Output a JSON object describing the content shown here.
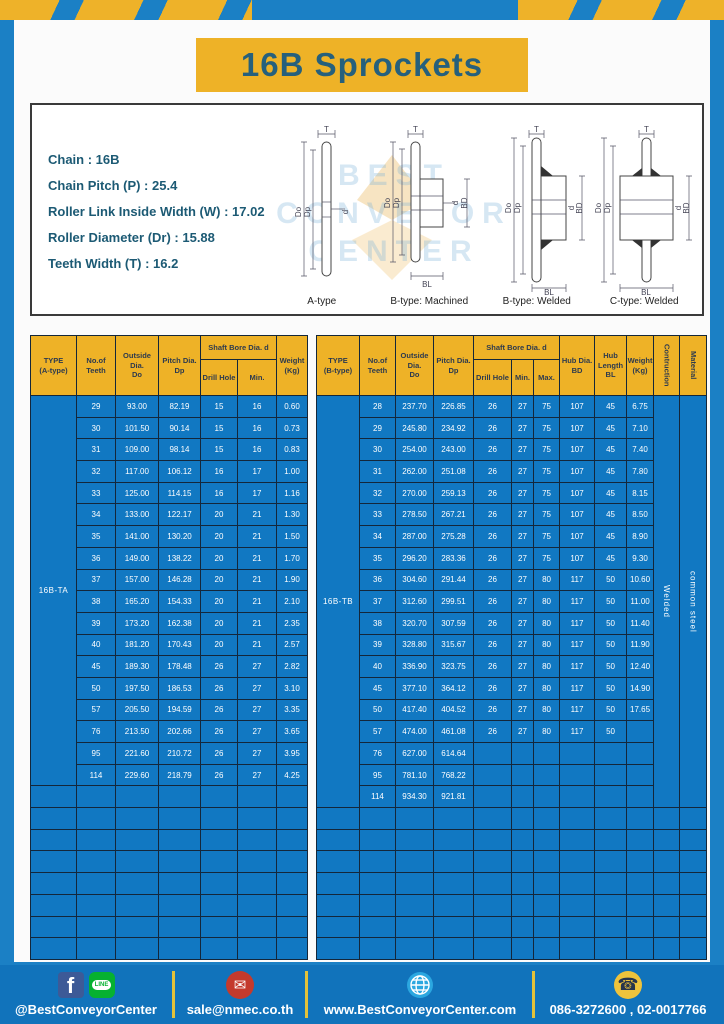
{
  "title": "16B Sprockets",
  "specs": {
    "lines": [
      "Chain  :  16B",
      "Chain Pitch (P)  :  25.4",
      "Roller Link Inside Width (W)  :  17.02",
      "Roller Diameter (Dr)  : 15.88",
      "Teeth Width (T)  :  16.2"
    ]
  },
  "dims": {
    "T": "T",
    "Do": "Do",
    "Dp": "Dp",
    "d": "d",
    "BD": "BD",
    "BL": "BL"
  },
  "watermark": "BEST CONVEYOR CENTER",
  "drawings": [
    {
      "caption": "A-type"
    },
    {
      "caption": "B-type: Machined"
    },
    {
      "caption": "B-type: Welded"
    },
    {
      "caption": "C-type: Welded"
    }
  ],
  "table_a": {
    "type_label": "16B-TA",
    "headers": {
      "type": "TYPE\n(A-type)",
      "teeth": "No.of\nTeeth",
      "outside": "Outside\nDia.\nDo",
      "pitch": "Pitch Dia.\nDp",
      "shaft_group": "Shaft Bore Dia. d",
      "drill": "Drill Hole",
      "min": "Min.",
      "weight": "Weight\n(Kg)"
    },
    "rows": [
      [
        "29",
        "93.00",
        "82.19",
        "15",
        "16",
        "0.60"
      ],
      [
        "30",
        "101.50",
        "90.14",
        "15",
        "16",
        "0.73"
      ],
      [
        "31",
        "109.00",
        "98.14",
        "15",
        "16",
        "0.83"
      ],
      [
        "32",
        "117.00",
        "106.12",
        "16",
        "17",
        "1.00"
      ],
      [
        "33",
        "125.00",
        "114.15",
        "16",
        "17",
        "1.16"
      ],
      [
        "34",
        "133.00",
        "122.17",
        "20",
        "21",
        "1.30"
      ],
      [
        "35",
        "141.00",
        "130.20",
        "20",
        "21",
        "1.50"
      ],
      [
        "36",
        "149.00",
        "138.22",
        "20",
        "21",
        "1.70"
      ],
      [
        "37",
        "157.00",
        "146.28",
        "20",
        "21",
        "1.90"
      ],
      [
        "38",
        "165.20",
        "154.33",
        "20",
        "21",
        "2.10"
      ],
      [
        "39",
        "173.20",
        "162.38",
        "20",
        "21",
        "2.35"
      ],
      [
        "40",
        "181.20",
        "170.43",
        "20",
        "21",
        "2.57"
      ],
      [
        "45",
        "189.30",
        "178.48",
        "26",
        "27",
        "2.82"
      ],
      [
        "50",
        "197.50",
        "186.53",
        "26",
        "27",
        "3.10"
      ],
      [
        "57",
        "205.50",
        "194.59",
        "26",
        "27",
        "3.35"
      ],
      [
        "76",
        "213.50",
        "202.66",
        "26",
        "27",
        "3.65"
      ],
      [
        "95",
        "221.60",
        "210.72",
        "26",
        "27",
        "3.95"
      ],
      [
        "114",
        "229.60",
        "218.79",
        "26",
        "27",
        "4.25"
      ]
    ],
    "empty_rows": 8
  },
  "table_b": {
    "type_label": "16B-TB",
    "headers": {
      "type": "TYPE\n(B-type)",
      "teeth": "No.of\nTeeth",
      "outside": "Outside\nDia.\nDo",
      "pitch": "Pitch Dia.\nDp",
      "shaft_group": "Shaft Bore Dia. d",
      "drill": "Drill Hole",
      "min": "Min.",
      "max": "Max.",
      "hub_dia": "Hub Dia.\nBD",
      "hub_len": "Hub\nLength\nBL",
      "weight": "Weight\n(Kg)",
      "construction": "Contruction",
      "material": "Material"
    },
    "construction_value": "Welded",
    "material_value": "common steel",
    "rows": [
      [
        "28",
        "237.70",
        "226.85",
        "26",
        "27",
        "75",
        "107",
        "45",
        "6.75"
      ],
      [
        "29",
        "245.80",
        "234.92",
        "26",
        "27",
        "75",
        "107",
        "45",
        "7.10"
      ],
      [
        "30",
        "254.00",
        "243.00",
        "26",
        "27",
        "75",
        "107",
        "45",
        "7.40"
      ],
      [
        "31",
        "262.00",
        "251.08",
        "26",
        "27",
        "75",
        "107",
        "45",
        "7.80"
      ],
      [
        "32",
        "270.00",
        "259.13",
        "26",
        "27",
        "75",
        "107",
        "45",
        "8.15"
      ],
      [
        "33",
        "278.50",
        "267.21",
        "26",
        "27",
        "75",
        "107",
        "45",
        "8.50"
      ],
      [
        "34",
        "287.00",
        "275.28",
        "26",
        "27",
        "75",
        "107",
        "45",
        "8.90"
      ],
      [
        "35",
        "296.20",
        "283.36",
        "26",
        "27",
        "75",
        "107",
        "45",
        "9.30"
      ],
      [
        "36",
        "304.60",
        "291.44",
        "26",
        "27",
        "80",
        "117",
        "50",
        "10.60"
      ],
      [
        "37",
        "312.60",
        "299.51",
        "26",
        "27",
        "80",
        "117",
        "50",
        "11.00"
      ],
      [
        "38",
        "320.70",
        "307.59",
        "26",
        "27",
        "80",
        "117",
        "50",
        "11.40"
      ],
      [
        "39",
        "328.80",
        "315.67",
        "26",
        "27",
        "80",
        "117",
        "50",
        "11.90"
      ],
      [
        "40",
        "336.90",
        "323.75",
        "26",
        "27",
        "80",
        "117",
        "50",
        "12.40"
      ],
      [
        "45",
        "377.10",
        "364.12",
        "26",
        "27",
        "80",
        "117",
        "50",
        "14.90"
      ],
      [
        "50",
        "417.40",
        "404.52",
        "26",
        "27",
        "80",
        "117",
        "50",
        "17.65"
      ],
      [
        "57",
        "474.00",
        "461.08",
        "26",
        "27",
        "80",
        "117",
        "50",
        ""
      ],
      [
        "76",
        "627.00",
        "614.64",
        "",
        "",
        "",
        "",
        "",
        ""
      ],
      [
        "95",
        "781.10",
        "768.22",
        "",
        "",
        "",
        "",
        "",
        ""
      ],
      [
        "114",
        "934.30",
        "921.81",
        "",
        "",
        "",
        "",
        "",
        ""
      ]
    ],
    "empty_rows": 7
  },
  "footer": {
    "items": [
      {
        "icons": [
          "facebook-icon",
          "line-icon"
        ],
        "label": "@BestConveyorCenter"
      },
      {
        "icons": [
          "email-icon"
        ],
        "label": "sale@nmec.co.th"
      },
      {
        "icons": [
          "globe-icon"
        ],
        "label": "www.BestConveyorCenter.com"
      },
      {
        "icons": [
          "phone-icon"
        ],
        "label": "086-3272600 , 02-0017766"
      }
    ],
    "line_icon_text": "LINE",
    "fb_icon_text": "f"
  },
  "colors": {
    "frame_blue": "#1b80c5",
    "accent_yellow": "#eeb227",
    "table_blue": "#1178c2",
    "footer_blue": "#1173bb",
    "title_text": "#26607c",
    "header_text": "#2d3a4e"
  }
}
